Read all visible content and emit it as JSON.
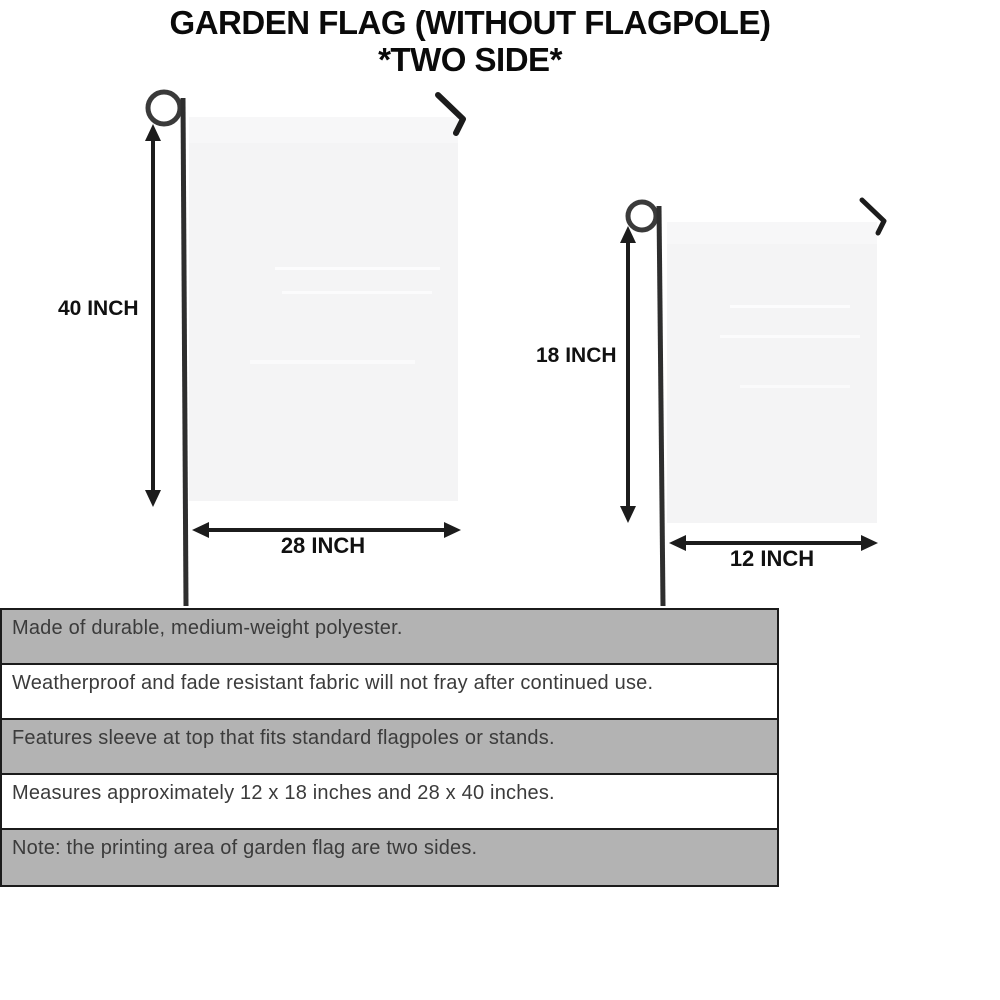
{
  "title": {
    "line1": "GARDEN FLAG (WITHOUT FLAGPOLE)",
    "line2": "*TWO SIDE*"
  },
  "large_flag": {
    "height_label": "40 INCH",
    "width_label": "28 INCH"
  },
  "small_flag": {
    "height_label": "18 INCH",
    "width_label": "12 INCH"
  },
  "spec_rows": [
    "Made of durable, medium-weight polyester.",
    "Weatherproof and fade resistant fabric will not fray after continued use.",
    "Features sleeve at top that fits standard flagpoles or stands.",
    "Measures approximately 12 x 18 inches and 28 x 40 inches.",
    "Note: the printing area of garden flag are two sides."
  ],
  "icons": {
    "pole_loop": "pole-loop-icon",
    "hanger_hook": "hanger-hook-icon",
    "dimension_arrow": "double-headed-arrow"
  },
  "colors": {
    "row_gray": "#b3b3b3",
    "row_white": "#ffffff",
    "table_border": "#1b1b1b",
    "flag_fill": "#f4f4f5",
    "flag_sleeve": "#f7f7f8",
    "pole": "#2e2e2e",
    "arrow": "#1c1c1c",
    "body_text": "#3b3b3b",
    "title_text": "#0a0a0a"
  }
}
